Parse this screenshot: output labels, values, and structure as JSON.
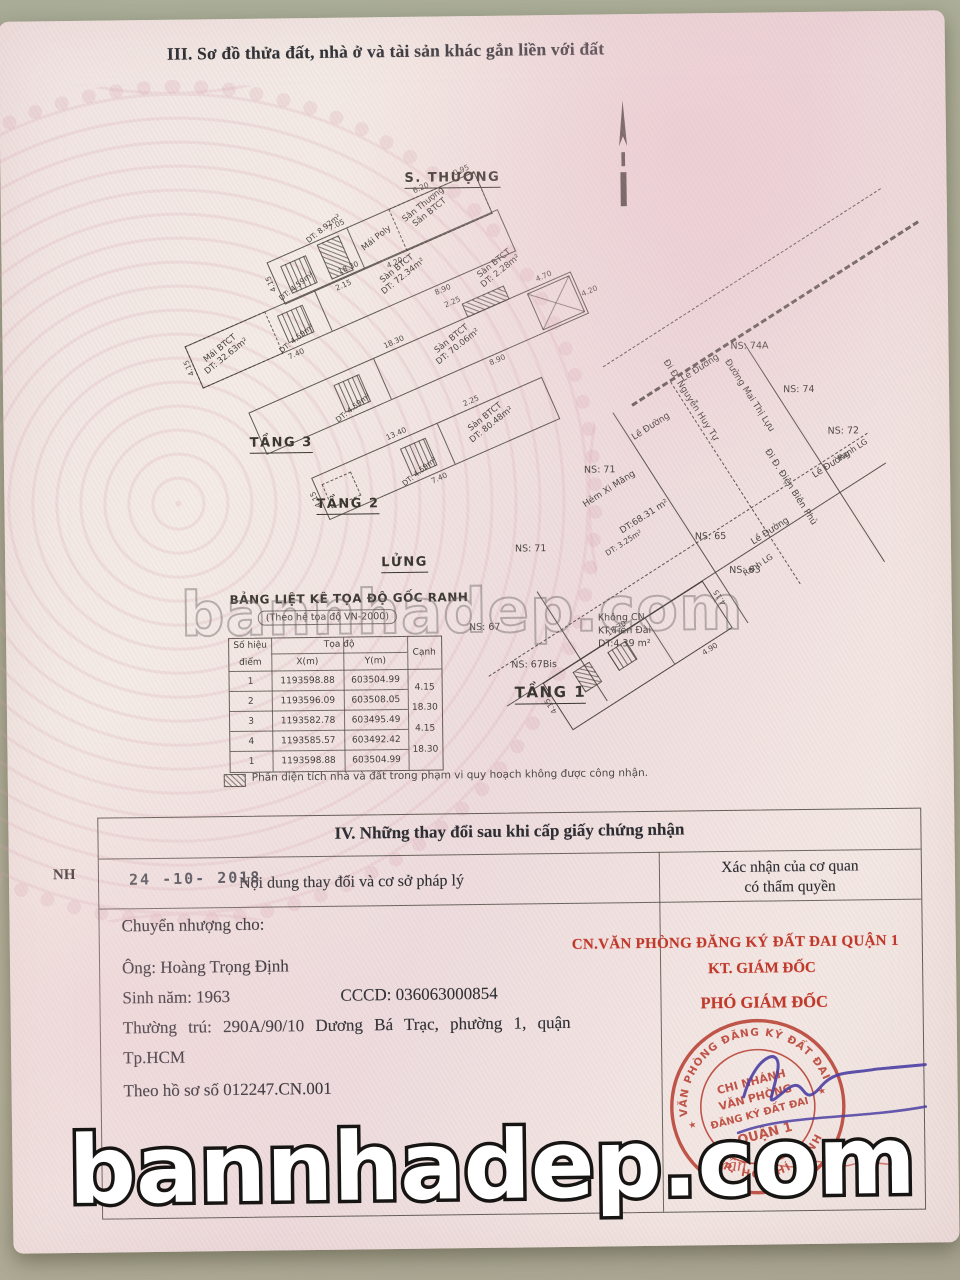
{
  "colors": {
    "stamp_red": "#c0392b",
    "signature_purple": "#4c3fa3",
    "paper_pink": "#f1e2e2",
    "desk_tan": "#b2af9a"
  },
  "watermarks": {
    "middle": "bannhadep.com",
    "bottom": "bannhadep.com"
  },
  "section3": {
    "title": "III. Sơ đồ thửa đất, nhà ở và tài sản khác gắn liền với đất",
    "plans": {
      "s_thuong": {
        "floor_label": "S. THƯỢNG",
        "area1": "Sân Thượng",
        "area1b": "Sân BTCT",
        "area2": "DT: 8.92m²",
        "area3": "Mái Poly",
        "stairs": "DT: 4.59m²",
        "dims": [
          "7.05",
          "6.20",
          "4.20",
          "2.15",
          "4.15",
          "0.95"
        ]
      },
      "tang3": {
        "floor_label": "TẦNG 3",
        "main": "Sàn BTCT",
        "main_area": "DT: 72.34m²",
        "annex": "Mái BTCT",
        "annex_area": "DT: 32.63m²",
        "stairs": "DT: 4.59m²",
        "dims": [
          "18.30",
          "7.40",
          "8.90",
          "4.15"
        ]
      },
      "tang2": {
        "floor_label": "TẦNG 2",
        "main": "Sàn BTCT",
        "main_area": "DT: 70.06m²",
        "balcony": "Sàn BTCT",
        "balcony_area": "DT: 2.28m²",
        "stairs": "DT: 4.59m²",
        "dims": [
          "18.30",
          "2.25",
          "8.90",
          "4.70",
          "4.20"
        ]
      },
      "lung": {
        "floor_label": "LỬNG",
        "main": "Sàn BTCT",
        "main_area": "DT: 80.48m²",
        "stairs": "DT: 4.59m²",
        "dims": [
          "13.40",
          "2.25",
          "7.40",
          "4.15"
        ]
      },
      "tang1": {
        "floor_label": "TẦNG 1",
        "plot_area": "DT:68.31 m²",
        "alley": "Hẻm Xi Măng",
        "house_area": "DT: 3.25m²",
        "no_cn_1": "Không CN",
        "no_cn_2": "KT Tiền Đài",
        "no_cn_3": "DT:4.39 m²",
        "streets": [
          "Đi Đ. Nguyễn Huy Tự",
          "Đường Mai Thị Lựu",
          "Đi Đ. Điện Biên Phủ"
        ],
        "sidewalks": [
          "Lề Đường",
          "Lề Đường",
          "Lề Đường",
          "Lề Đường"
        ],
        "boundaries": [
          "Ranh LG",
          "Ranh LG"
        ],
        "neighbors": [
          "NS: 74A",
          "NS: 74",
          "NS: 72",
          "NS: 71",
          "NS: 71",
          "NS: 65",
          "NS: 63",
          "NS: 67",
          "NS: 67Bis"
        ],
        "dims": [
          "18.30",
          "4.15",
          "4.90",
          "4.15"
        ]
      }
    },
    "coord_table": {
      "title": "BẢNG LIỆT KÊ TỌA ĐỘ GỐC RANH",
      "subtitle": "(Theo hệ tọa độ VN-2000)",
      "col_point_1": "Số hiệu",
      "col_point_2": "điểm",
      "col_coord": "Tọa độ",
      "col_x": "X(m)",
      "col_y": "Y(m)",
      "col_edge": "Cạnh",
      "rows": [
        {
          "p": "1",
          "x": "1193598.88",
          "y": "603504.99"
        },
        {
          "p": "2",
          "x": "1193596.09",
          "y": "603508.05"
        },
        {
          "p": "3",
          "x": "1193582.78",
          "y": "603495.49"
        },
        {
          "p": "4",
          "x": "1193585.57",
          "y": "603492.42"
        },
        {
          "p": "1",
          "x": "1193598.88",
          "y": "603504.99"
        }
      ],
      "edges": [
        "4.15",
        "18.30",
        "4.15",
        "18.30"
      ]
    },
    "note": "Phần diện tích nhà và đất trong phạm vi quy hoạch không được công nhận."
  },
  "section4": {
    "title": "IV. Những thay đổi sau khi cấp giấy chứng nhận",
    "margin_note": "NH",
    "date_stamp": "24 -10- 2018",
    "col_left": "Nội dung thay đổi và cơ sở pháp lý",
    "col_right_1": "Xác nhận của cơ quan",
    "col_right_2": "có thẩm quyền",
    "body": {
      "line1": "Chuyển nhượng cho:",
      "line2": "Ông: Hoàng Trọng Định",
      "line3a": "Sinh năm: 1963",
      "line3b": "CCCD: 036063000854",
      "line4": "Thường trú: 290A/90/10 Dương Bá Trạc, phường 1, quận",
      "line5": "Tp.HCM",
      "line6": "Theo hồ sơ số 012247.CN.001"
    },
    "office": {
      "line1": "CN.VĂN PHÒNG ĐĂNG KÝ ĐẤT ĐAI QUẬN 1",
      "line2": "KT. GIÁM ĐỐC",
      "line3": "PHÓ GIÁM ĐỐC"
    },
    "stamp": {
      "ring_top": "VĂN PHÒNG ĐĂNG KÝ ĐẤT ĐAI",
      "ring_bottom": "TP. HỒ CHÍ MINH",
      "center1": "CHI NHÁNH",
      "center2": "VĂN PHÒNG",
      "center3": "ĐĂNG KÝ ĐẤT ĐAI",
      "center4": "QUẬN 1",
      "signed_name": "Trần"
    }
  }
}
